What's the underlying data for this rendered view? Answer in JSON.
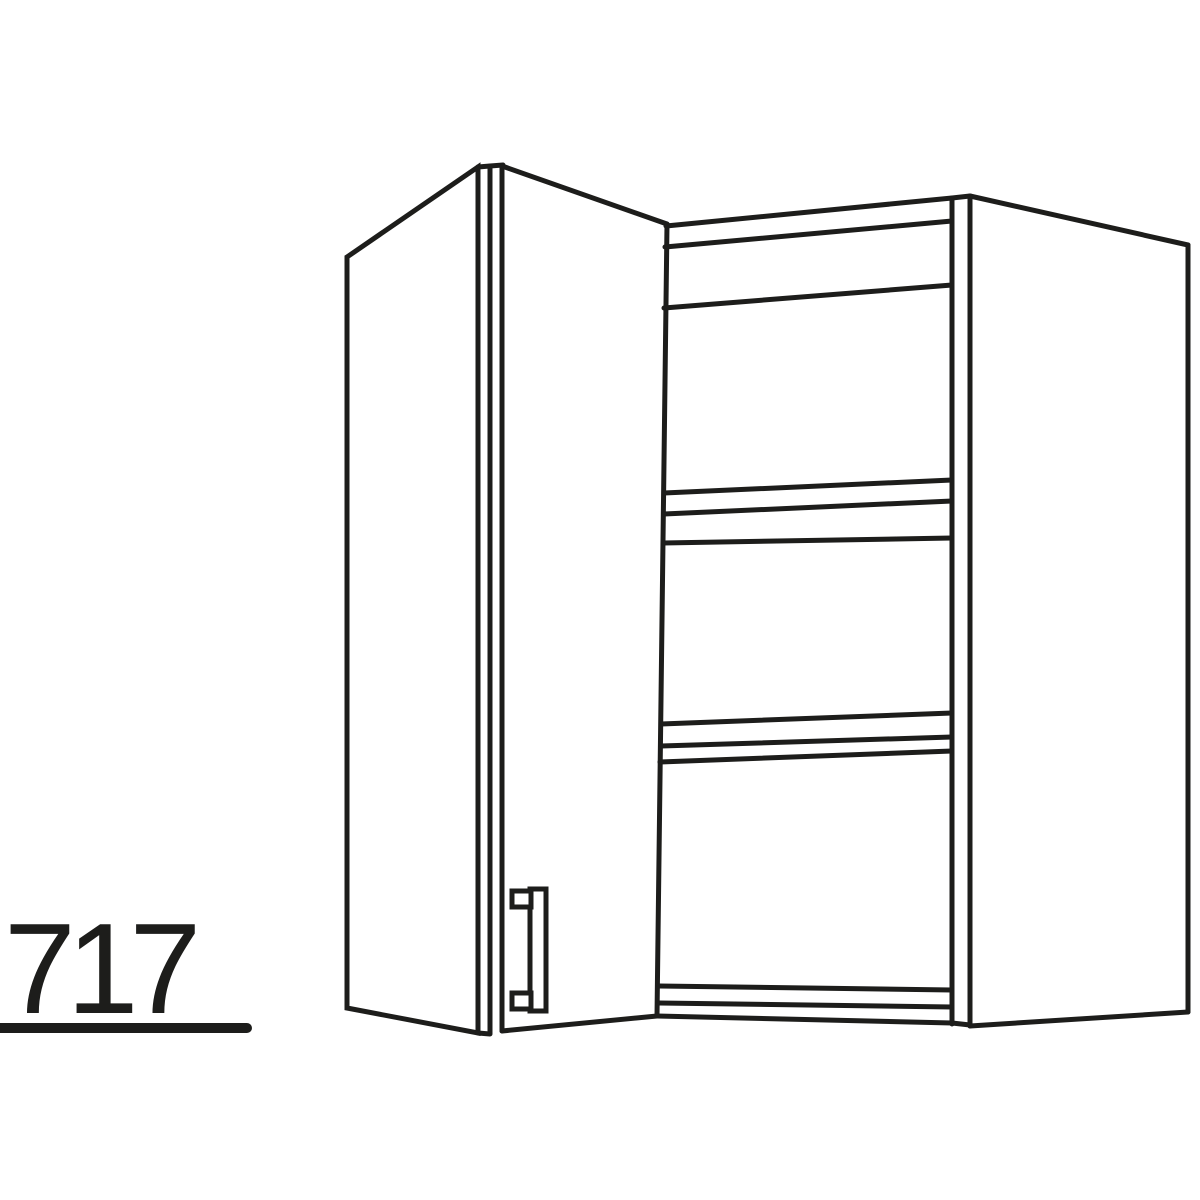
{
  "figure": {
    "type": "technical line drawing",
    "subject": "corner wall cabinet with open hinged door and interior shelves",
    "background_color": "#ffffff",
    "line_color": "#1d1d1b",
    "shelf_count": 2
  },
  "height_label": {
    "value": "717",
    "underline": true
  },
  "parts": [
    "open-door",
    "door-handle",
    "carcass-left-front-face",
    "interior-top-panel",
    "upper-shelf",
    "lower-shelf",
    "interior-bottom-panel",
    "right-side-panel"
  ]
}
